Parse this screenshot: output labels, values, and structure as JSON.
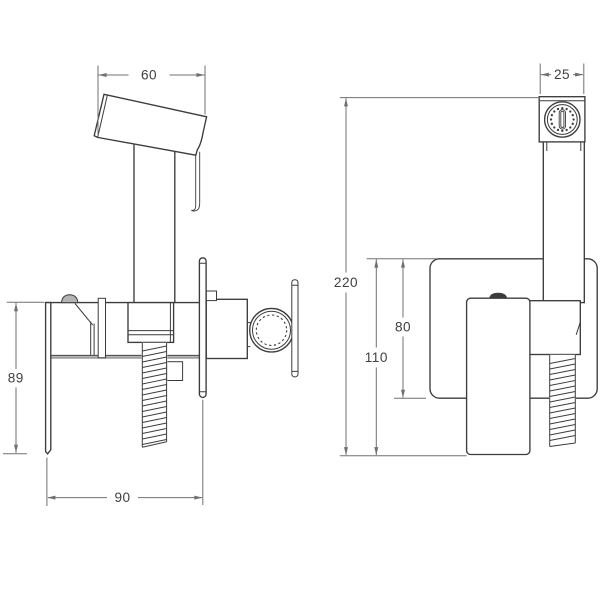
{
  "colors": {
    "background": "#ffffff",
    "line": "#3c3c3c",
    "dim": "#707070",
    "gray": "#9e9e9e",
    "text": "#3f3f3f"
  },
  "dims": {
    "d60": {
      "label": "60"
    },
    "d89": {
      "label": "89"
    },
    "d90": {
      "label": "90"
    },
    "d25": {
      "label": "25"
    },
    "d220": {
      "label": "220"
    },
    "d110": {
      "label": "110"
    },
    "d80": {
      "label": "80"
    }
  }
}
